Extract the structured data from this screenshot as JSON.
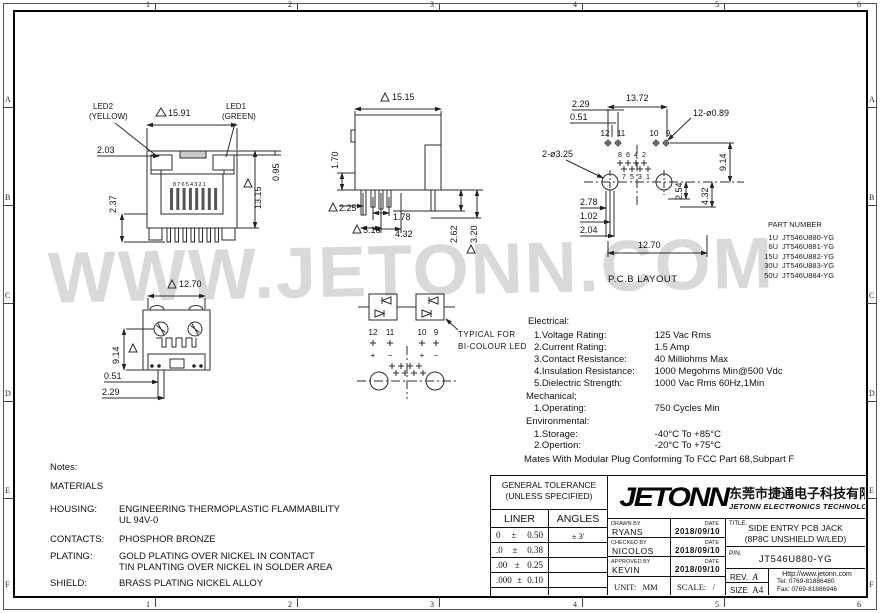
{
  "frame": {
    "cols": [
      "1",
      "2",
      "3",
      "4",
      "5",
      "6"
    ],
    "rows": [
      "A",
      "B",
      "C",
      "D",
      "E",
      "F"
    ]
  },
  "watermark": "WWW.JETONN.COM",
  "views": {
    "front": {
      "led2_label": "LED2",
      "led2_color": "(YELLOW)",
      "led1_label": "LED1",
      "led1_color": "(GREEN)",
      "pin_numbers": "87654321",
      "dim_width": "15.91",
      "dim_height": "13.15",
      "dim_led_top": "0.95",
      "dim_led_side": "2.03",
      "dim_leg": "2.37"
    },
    "side": {
      "dim_width": "15.15",
      "dim_depth": "1.70",
      "dim_a": "2.25",
      "dim_b": "5.16",
      "dim_c": "1.78",
      "dim_d": "4.32",
      "dim_e": "2.62",
      "dim_f": "3.20"
    },
    "pcb": {
      "label": "P.C.B LAYOUT",
      "dim_top": "13.72",
      "dim_b": "2.29",
      "dim_c": "0.51",
      "note_small_holes": "12-ø0.89",
      "note_big_holes": "2-ø3.25",
      "dim_right_a": "9.14",
      "dim_right_b": "4.32",
      "dim_right_c": "2.54",
      "dim_left_a": "2.78",
      "dim_left_b": "1.02",
      "dim_left_c": "2.04",
      "dim_bottom": "12.70",
      "pin12": "12",
      "pin11": "11",
      "pin10": "10",
      "pin9": "9",
      "pin8": "8",
      "pin6": "6",
      "pin4": "4",
      "pin2": "2",
      "pin7": "7",
      "pin5": "5",
      "pin3": "3",
      "pin1": "1"
    },
    "bottom": {
      "dim_width": "12.70",
      "dim_height": "9.14",
      "dim_a": "0.51",
      "dim_b": "2.29"
    },
    "led": {
      "note_line1": "TYPICAL FOR",
      "note_line2": "BI-COLOUR LED",
      "pin12": "12",
      "pin11": "11",
      "pin10": "10",
      "pin9": "9",
      "pol12": "+",
      "pol11": "−",
      "pol10": "+",
      "pol9": "−"
    }
  },
  "part_table": {
    "title": "PART NUMBER",
    "rows": [
      {
        "qty": "1U",
        "pn": "JT546U880-YG"
      },
      {
        "qty": "6U",
        "pn": "JT546U881-YG"
      },
      {
        "qty": "15U",
        "pn": "JT546U882-YG"
      },
      {
        "qty": "30U",
        "pn": "JT546U883-YG"
      },
      {
        "qty": "50U",
        "pn": "JT546U884-YG"
      }
    ]
  },
  "specs": {
    "electrical_title": "Electrical:",
    "electrical": [
      {
        "label": "1.Voltage Rating:",
        "value": "125 Vac Rms"
      },
      {
        "label": "2.Current Rating:",
        "value": "1.5 Amp"
      },
      {
        "label": "3.Contact Resistance:",
        "value": "40 Milliohms Max"
      },
      {
        "label": "4.Insulation Resistance:",
        "value": "1000 Megohms Min@500 Vdc"
      },
      {
        "label": "5.Dielectric Strength:",
        "value": "1000 Vac Rms 60Hz,1Min"
      }
    ],
    "mechanical_title": "Mechanical;",
    "mechanical": [
      {
        "label": "1.Operating:",
        "value": "750 Cycles Min"
      }
    ],
    "environmental_title": "Environmental:",
    "environmental": [
      {
        "label": "1.Storage:",
        "value": "-40°C To +85°C"
      },
      {
        "label": "2.Opertion:",
        "value": "-20°C To +75°C"
      }
    ],
    "footer": "Mates With Modular Plug Conforming To FCC Part 68,Subpart F"
  },
  "notes": {
    "title": "Notes:",
    "materials": "MATERIALS",
    "housing_label": "HOUSING:",
    "housing_value1": "ENGINEERING THERMOPLASTIC FLAMMABILITY",
    "housing_value2": "UL 94V-0",
    "contacts_label": "CONTACTS:",
    "contacts_value": "PHOSPHOR BRONZE",
    "plating_label": "PLATING:",
    "plating_value1": "GOLD PLATING OVER NICKEL IN CONTACT",
    "plating_value2": "TIN PLANTING OVER NICKEL IN SOLDER AREA",
    "shield_label": "SHIELD:",
    "shield_value": "BRASS PLATING NICKEL ALLOY"
  },
  "title_block": {
    "tolerance_title1": "GENERAL TOLERANCE",
    "tolerance_title2": "(UNLESS SPECIFIED)",
    "liner_header": "LINER",
    "angles_header": "ANGLES",
    "tol_rows": [
      {
        "digits": "0",
        "pm": "±",
        "value": "0.50"
      },
      {
        "digits": ".0",
        "pm": "±",
        "value": "0.38"
      },
      {
        "digits": ".00",
        "pm": "±",
        "value": "0.25"
      },
      {
        "digits": ".000",
        "pm": "±",
        "value": "0.10"
      }
    ],
    "angles_value": "± 3'",
    "logo": "JETONN",
    "company_cn": "东莞市捷通电子科技有限公司",
    "company_en": "JETONN ELECTRONICS TECHNOLOGY",
    "drawn_label": "DRAWN BY",
    "drawn_name": "RYANS",
    "drawn_date": "2018/09/10",
    "checked_label": "CHECKED BY",
    "checked_name": "NICOLOS",
    "checked_date": "2018/09/10",
    "approved_label": "APPROVED BY",
    "approved_name": "KEVIN",
    "approved_date": "2018/09/10",
    "date_label": "DATE",
    "unit_label": "UNIT:",
    "unit_value": "MM",
    "scale_label": "SCALE:",
    "scale_value": "/",
    "title_label": "TITLE.",
    "title_line1": "SIDE ENTRY PCB JACK",
    "title_line2": "(8P8C UNSHIELD W/LED)",
    "pn_label": "P/N.",
    "pn_value": "JT546U880-YG",
    "rev_label": "REV.",
    "rev_value": "A",
    "size_label": "SIZE",
    "size_value": "A4",
    "web": "Http://www.jetonn.com",
    "tel": "Tel: 0769-81886480",
    "fax": "Fax: 0769-81886946"
  }
}
